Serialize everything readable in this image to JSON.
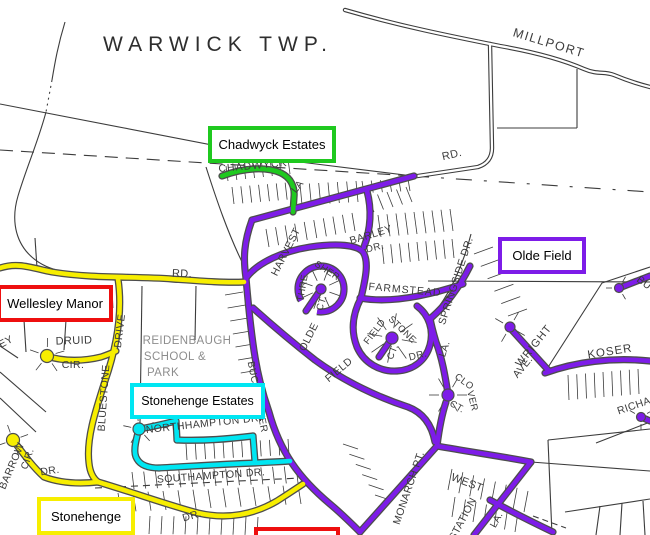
{
  "map": {
    "township_label": "WARWICK TWP.",
    "neighborhoods": {
      "chadwyck": {
        "label": "Chadwyck Estates",
        "color": "#1fc91f"
      },
      "olde_field": {
        "label": "Olde Field",
        "color": "#7d1ce8"
      },
      "wellesley": {
        "label": "Wellesley Manor",
        "color": "#ee0f0f"
      },
      "stonehenge_estates": {
        "label": "Stonehenge Estates",
        "color": "#00e6f2"
      },
      "stonehenge": {
        "label": "Stonehenge",
        "color": "#f7ee00"
      },
      "partial_bottom": {
        "label": "",
        "color": "#ee0f0f"
      }
    },
    "streets": {
      "millport": "MILLPORT",
      "rd_top": "RD.",
      "rd_mid": "RD.",
      "chadwyck": "CHADWYCK",
      "chadwyck_la": "LA",
      "harvest": "HARVEST",
      "barley": "BARLEY",
      "barley_dr": "DR.",
      "thresher_a": "THRE",
      "thresher_b": "SHER",
      "thresher_ct": "CT.",
      "farmstead": "FARMSTEAD",
      "springside": "SPRINGSIDE DR.",
      "buckwalter": "BUCKWALTER",
      "olde": "OLDE",
      "field": "FIELD",
      "fieldstone_a": "FIELD",
      "fieldstone_b": "STONE",
      "fieldstone_ct": "CT.",
      "fieldstone_dr": "DR.",
      "la_mid": "LA.",
      "clover_a": "CLO",
      "clover_b": "VER",
      "clover_ct": "CT.",
      "wright": "WRIGHT",
      "wright_ave": "AVE.",
      "koser": "KOSER",
      "richa": "RICHA",
      "bu": "BU",
      "monarch": "MONARCH PT.",
      "west": "WEST",
      "station": "STATION",
      "la_south": "LA.",
      "northampton": "NORTHHAMPTON DR.",
      "southampton": "SOUTHAMPTON DR.",
      "dr_south": "DR.",
      "barrow": "BARROW",
      "barrow_cir": "CIR.",
      "dr_barrow": "DR.",
      "druid": "DRUID",
      "druid_cir": "CIR.",
      "bluestone": "BLUESTONE",
      "bluestone_drive": "DRIVE",
      "ey": "EY",
      "reidenbaugh_1": "REIDENBAUGH",
      "reidenbaugh_2": "SCHOOL &",
      "reidenbaugh_3": "PARK"
    }
  }
}
